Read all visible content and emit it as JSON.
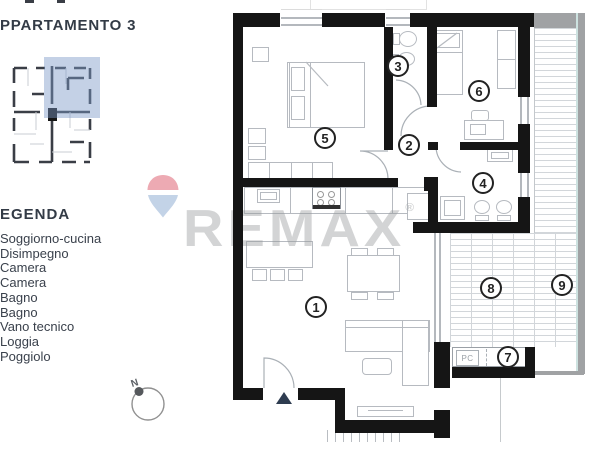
{
  "header": {
    "title": "PPARTAMENTO 3"
  },
  "legend": {
    "heading": "EGENDA",
    "items": [
      "Soggiorno-cucina",
      "Disimpegno",
      "Camera",
      "Camera",
      "Bagno",
      "Bagno",
      "Vano tecnico",
      "Loggia",
      "Poggiolo"
    ]
  },
  "compass": {
    "label": "N"
  },
  "watermark": {
    "text": "REMAX",
    "registered": "®",
    "balloon_red": "#edaab3",
    "balloon_blue": "#c3d3e7",
    "text_color": "rgba(150,152,155,0.42)"
  },
  "plan": {
    "markers": [
      "1",
      "2",
      "3",
      "4",
      "5",
      "6",
      "7",
      "8",
      "9"
    ],
    "pc_label": "PC",
    "wall_color": "#151515",
    "unit_highlight_color": "rgba(125,152,199,0.45)",
    "hatch_color": "#d2d6da"
  }
}
